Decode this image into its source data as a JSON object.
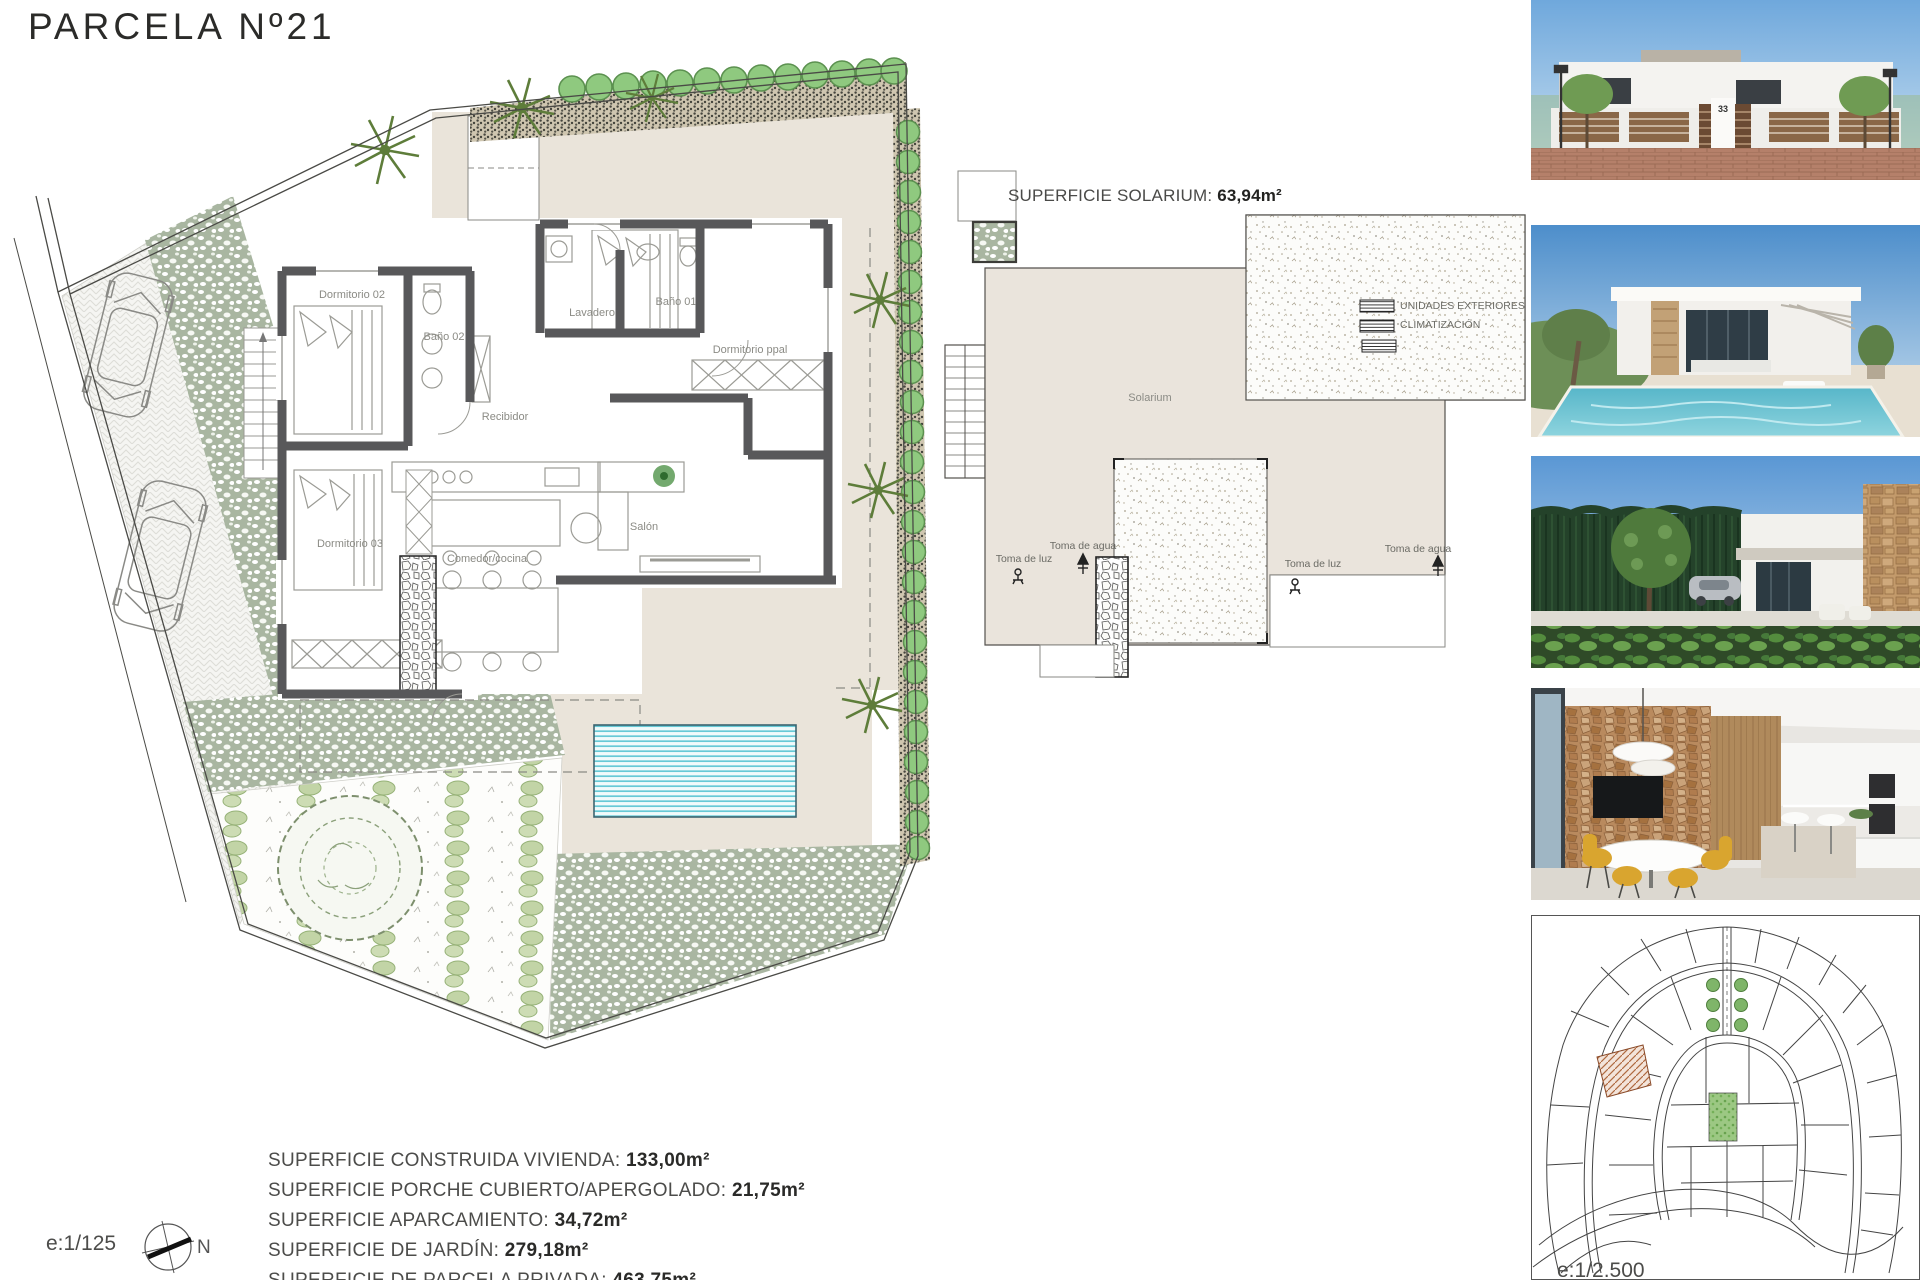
{
  "title": "PARCELA Nº21",
  "floor_plan": {
    "scale_label": "e:1/125",
    "compass_north": "N",
    "rooms": {
      "dorm2": "Dormitorio 02",
      "bath2": "Baño 02",
      "laundry": "Lavadero",
      "bath1": "Baño 01",
      "master": "Dormitorio ppal",
      "hall": "Recibidor",
      "dorm3": "Dormitorio 03",
      "kitchen": "Comedor/cocina",
      "living": "Salón"
    }
  },
  "solarium_plan": {
    "area_title_label": "SUPERFICIE SOLARIUM:",
    "area_title_value": "63,94m²",
    "room_label": "Solarium",
    "ac_units_line1": "UNIDADES EXTERIORES",
    "ac_units_line2": "CLIMATIZACIÓN",
    "water_tap_label": "Toma de agua",
    "light_tap_label": "Toma de luz"
  },
  "surface_stats": {
    "rows": [
      {
        "label": "SUPERFICIE CONSTRUIDA VIVIENDA:",
        "value": "133,00m²"
      },
      {
        "label": "SUPERFICIE PORCHE CUBIERTO/APERGOLADO:",
        "value": "21,75m²"
      },
      {
        "label": "SUPERFICIE APARCAMIENTO:",
        "value": "34,72m²"
      },
      {
        "label": "SUPERFICIE DE JARDÍN:",
        "value": "279,18m²"
      },
      {
        "label": "SUPERFICIE DE PARCELA PRIVADA:",
        "value": "463,75m²"
      }
    ]
  },
  "photos": {
    "house_number": "33",
    "items": [
      {
        "name": "street-facade-render"
      },
      {
        "name": "pool-villa-render"
      },
      {
        "name": "garden-side-render"
      },
      {
        "name": "kitchen-interior-render"
      }
    ]
  },
  "site_map": {
    "scale_label": "e:1/2.500"
  },
  "colors": {
    "deck_beige": "#eae4da",
    "wall_gray": "#58585a",
    "pool_cyan": "#6fcdd8",
    "hedge_green": "#8fc97f",
    "paving_sage": "#a9b6a1"
  }
}
